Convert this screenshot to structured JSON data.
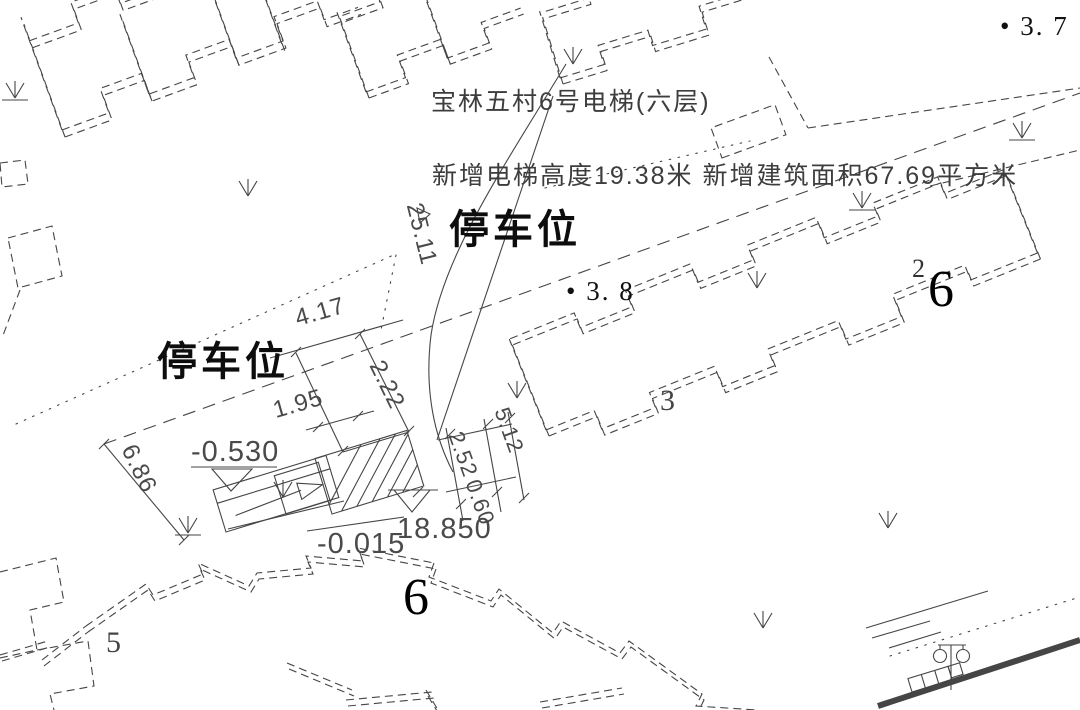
{
  "drawing": {
    "annotations": {
      "title_line1": "宝林五村6号电梯(六层)",
      "title_line2": "新增电梯高度19.38米 新增建筑面积67.69平方米",
      "parking_label_top": "停车位",
      "parking_label_left": "停车位",
      "spot_elev_38": "• 3. 8",
      "spot_elev_37": "• 3. 7"
    },
    "levels": {
      "outdoor": "-0.530",
      "entrance": "-0.015",
      "elevator_top": "18.850"
    },
    "dimensions": {
      "d_417": "4.17",
      "d_222": "2.22",
      "d_195": "1.95",
      "d_2511": "25.11",
      "d_686": "6.86",
      "d_252": "2.52",
      "d_060": "0.60",
      "d_512": "5.12"
    },
    "building_numbers": {
      "b6_right": "6",
      "b6_right_sup": "2",
      "b6_bottom": "6",
      "b3": "3",
      "b5": "5"
    },
    "colors": {
      "ink": "#454545",
      "bold_ink": "#0d0d0d",
      "background": "#ffffff"
    }
  }
}
